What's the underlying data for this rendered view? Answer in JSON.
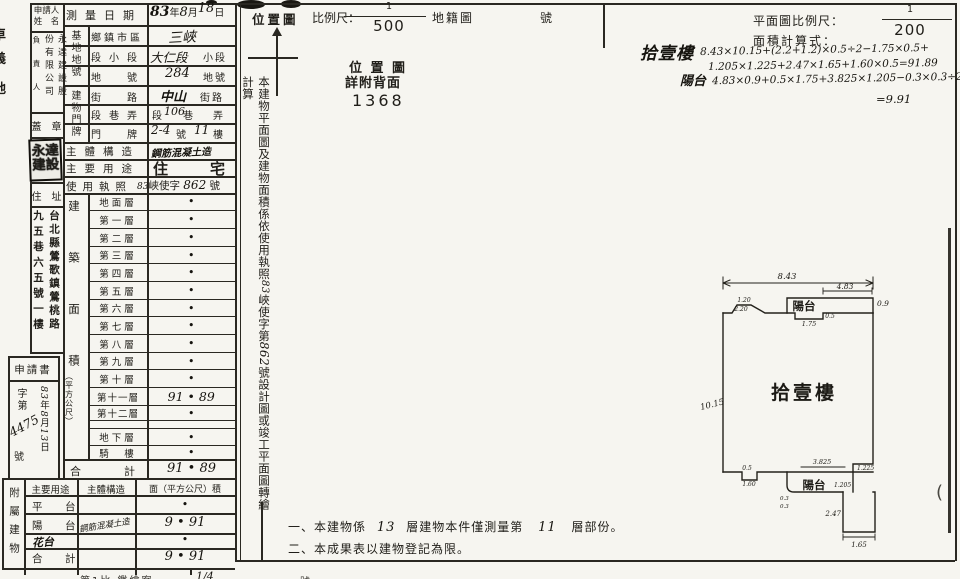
{
  "edge": {
    "c1": "卓",
    "c2": "義",
    "c3": "地",
    "paren": "("
  },
  "applicant": {
    "name_l1": "申請人",
    "name_l2": "姓　名",
    "role": "負責人",
    "company_right": "永達建設股",
    "company_left": "份有限公司",
    "seal_label": "蓋　章",
    "seal_l1": "永達",
    "seal_l2": "建設",
    "address_label": "住　址",
    "address_right": "台北縣鶯歌鎮鶯桃路",
    "address_left": "九五巷六五號一樓",
    "application_label": "申請書",
    "no_prefix": "字第",
    "no_value": "4475",
    "no_suffix": "號",
    "date_y": "83",
    "date_y_unit": "年",
    "date_m": "8",
    "date_m_unit": "月",
    "date_d": "13",
    "date_d_unit": "日"
  },
  "survey": {
    "label": "測量日期",
    "y": "83",
    "y_unit": "年",
    "m": "8",
    "m_unit": "月",
    "d": "18",
    "d_unit": "日"
  },
  "site": {
    "group": "基地地號",
    "r1_label": "鄉鎮市區",
    "r1_value": "三峽",
    "r2_label": "段小段",
    "r2_value": "大仁段",
    "r2_suffix": "小段",
    "r3_label": "地　號",
    "r3_value": "284",
    "r3_suffix": "地號"
  },
  "door": {
    "group": "建物門牌",
    "r1_label": "街　路",
    "r1_value": "中山",
    "r1_suffix": "街路",
    "r2_label": "段巷弄",
    "r2_pre": "段",
    "r2_value": "106",
    "r2_mid": "巷",
    "r2_suffix": "弄",
    "r3_label": "門　牌",
    "r3_value": "2-4",
    "r3_mid": "號",
    "r3_value2": "11",
    "r3_suffix": "樓"
  },
  "structure": {
    "label": "主體構造",
    "value": "鋼筋混凝土造"
  },
  "usage": {
    "label": "主要用途",
    "value": "住宅"
  },
  "license": {
    "label": "使用執照",
    "hw1": "83",
    "mid": "峽使字",
    "hw2": "862",
    "suffix": "號"
  },
  "floors": {
    "group": "建築面積",
    "unit": "（平方公尺）",
    "rows": [
      {
        "label": "地面層",
        "value": "•"
      },
      {
        "label": "第一層",
        "value": "•"
      },
      {
        "label": "第二層",
        "value": "•"
      },
      {
        "label": "第三層",
        "value": "•"
      },
      {
        "label": "第四層",
        "value": "•"
      },
      {
        "label": "第五層",
        "value": "•"
      },
      {
        "label": "第六層",
        "value": "•"
      },
      {
        "label": "第七層",
        "value": "•"
      },
      {
        "label": "第八層",
        "value": "•"
      },
      {
        "label": "第九層",
        "value": "•"
      },
      {
        "label": "第十層",
        "value": "•"
      },
      {
        "label": "第十一層",
        "value": "91 • 89"
      },
      {
        "label": "第十二層",
        "value": "•"
      },
      {
        "label": "",
        "value": ""
      },
      {
        "label": "地下層",
        "value": "•"
      },
      {
        "label": "騎　樓",
        "value": "•"
      }
    ],
    "total_label": "合　計",
    "total_value": "91 • 89"
  },
  "annex": {
    "side": "附屬建物",
    "h_use": "主要用途",
    "h_structure": "主體構造",
    "h_area": "面（平方公尺）積",
    "rows": [
      {
        "use": "平　台",
        "structure": "",
        "area": "•"
      },
      {
        "use": "陽　台",
        "structure": "鋼筋混凝土造",
        "area": "9 • 91"
      },
      {
        "use": "花台",
        "structure": "",
        "area": "•"
      },
      {
        "use": "合　計",
        "structure": "",
        "area": "9 • 91"
      }
    ]
  },
  "strip": {
    "seg1": "本建物平面圖及建物面積係依使用執照",
    "hw1": "83",
    "seg2": "峽使字第",
    "hw2": "862",
    "seg3": "號設計圖或竣工平面圖轉繪計算"
  },
  "location": {
    "title": "位置圖",
    "scale_label": "比例尺：",
    "num": "1",
    "den": "500",
    "map": "地籍圖",
    "no": "號",
    "body1": "位 置 圖",
    "body2": "詳附背面",
    "sheet": "1368"
  },
  "planhdr": {
    "scale_label": "平面圖比例尺：",
    "num": "1",
    "den": "200",
    "calc_label": "面積計算式："
  },
  "calc": {
    "floor": "拾壹樓",
    "l1": "8.43×10.15+(2.2+1.2)×0.5÷2−1.75×0.5+",
    "l2": "1.205×1.225+2.47×1.65+1.60×0.5=91.89",
    "balc": "陽台",
    "l3": "4.83×0.9+0.5×1.75+3.825×1.205−0.3×0.3÷2",
    "l4": "=9.91"
  },
  "plan": {
    "room": "拾壹樓",
    "balcony_top": "陽台",
    "balcony_bottom": "陽台",
    "d_w": "8.43",
    "d_h": "10.15",
    "d_balc_w": "4.83",
    "d_balc_d": "0.9",
    "d_bump_t": "1.20",
    "d_bump_b": "2.20",
    "d_notch_w": "1.75",
    "d_notch_d": "0.5",
    "d_bn_d": "0.5",
    "d_bn_w": "1.60",
    "d_bb_w": "3.825",
    "d_step": "1.225",
    "d_bb_d": "1.205",
    "d_prot_h": "2.47",
    "d_prot_w": "1.65",
    "d_ca": "0.3",
    "d_cb": "0.3"
  },
  "notes": {
    "n1_pre": "一、本建物係",
    "n1_hw1": "13",
    "n1_mid": "層建物本件僅測量第",
    "n1_hw2": "11",
    "n1_post": "層部份。",
    "n2": "二、本成果表以建物登記為限。"
  },
  "bottom": {
    "f1": "第1比 鑑繪案",
    "f2": "1/4",
    "f3": "號"
  }
}
